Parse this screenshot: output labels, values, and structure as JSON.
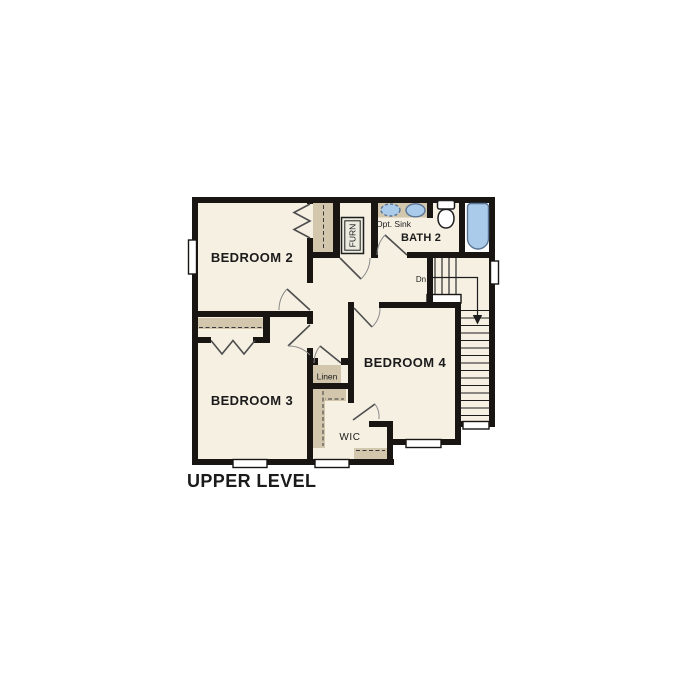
{
  "colors": {
    "paper": "#ffffff",
    "floor": "#f6f0e3",
    "wall": "#181512",
    "shelf": "#d2c6ad",
    "alcove": "#ffffff",
    "fixfill": "#abcbea",
    "fixstroke": "#5a7494",
    "ink": "#1b1b1b"
  },
  "plan": {
    "title": "UPPER LEVEL",
    "rooms": {
      "bedroom2": "BEDROOM 2",
      "bedroom3": "BEDROOM 3",
      "bedroom4": "BEDROOM 4",
      "bath2": "BATH 2"
    },
    "labels": {
      "opt_sink": "Opt. Sink",
      "furnace": "FURN",
      "linen": "Linen",
      "wic": "WIC",
      "stairs_down": "Dn"
    }
  }
}
